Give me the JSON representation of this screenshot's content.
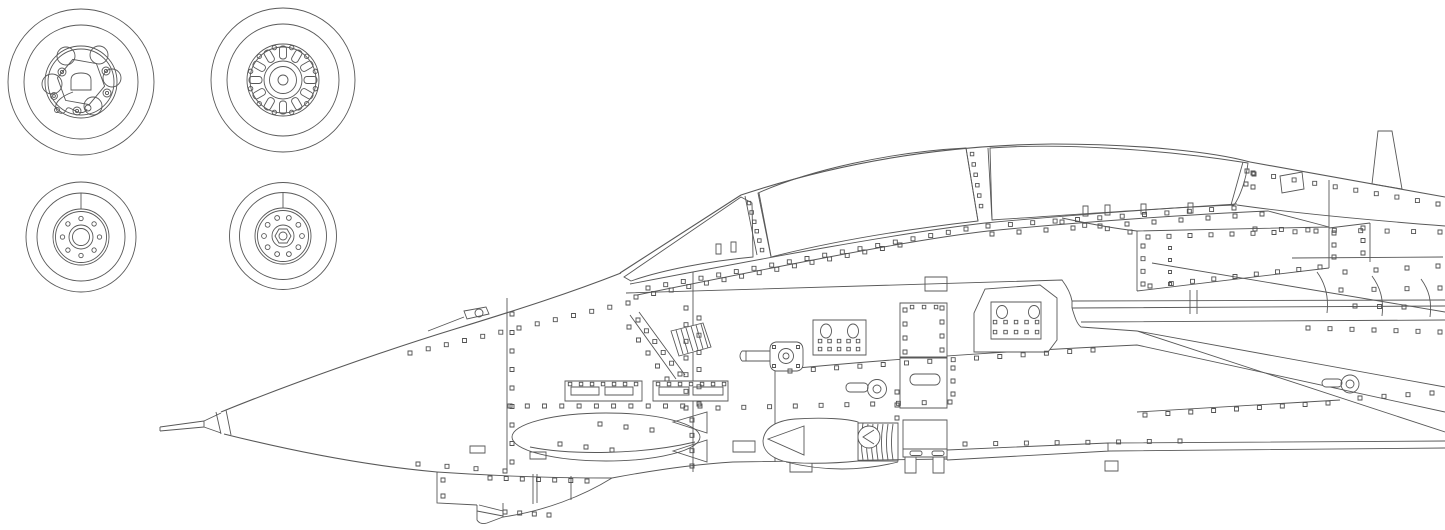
{
  "sheet": {
    "background_color": "#ffffff",
    "line_color": "#585858",
    "mask_color": "#ffe800"
  },
  "wheel_masks": {
    "count": 4,
    "items": [
      {
        "id": "main-wheel-left-mask"
      },
      {
        "id": "main-wheel-right-mask"
      },
      {
        "id": "nose-wheel-left-mask"
      },
      {
        "id": "nose-wheel-right-mask"
      }
    ]
  },
  "canopy_masks": {
    "count": 3,
    "items": [
      {
        "id": "windscreen-mask"
      },
      {
        "id": "canopy-front-section-mask"
      },
      {
        "id": "canopy-rear-section-mask"
      }
    ]
  }
}
